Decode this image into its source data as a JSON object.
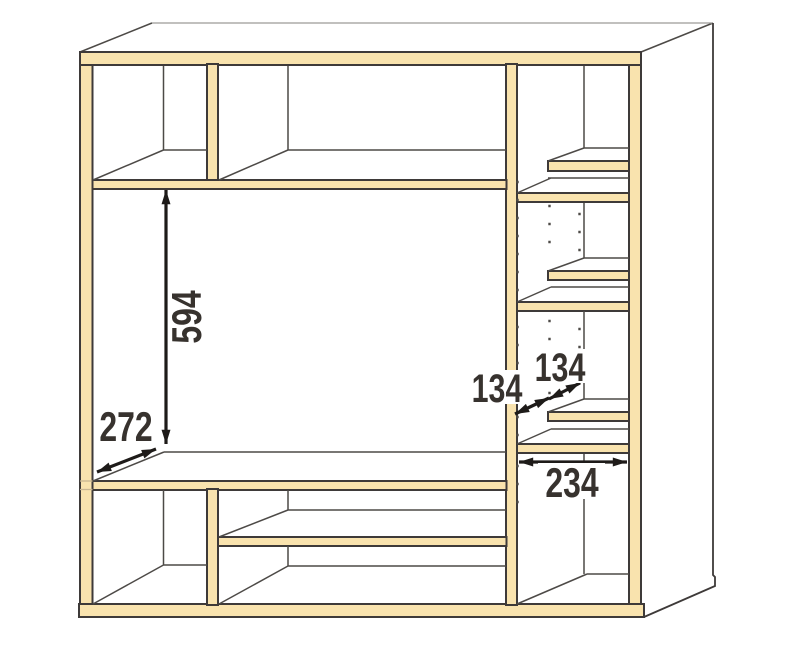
{
  "diagram": {
    "background": "#FFFFFF",
    "colors": {
      "wood": "#F9E3AE",
      "outline": "#3E3A39",
      "interior": "#4D4A47",
      "backline": "#9C9A98",
      "wood_shadow": "#C9B691",
      "dimension": "#1E1B19",
      "label": "#37322E"
    },
    "dimensions": [
      {
        "id": "opening-height",
        "value": "594"
      },
      {
        "id": "main-shelf-depth",
        "value": "272"
      },
      {
        "id": "side-front-shelf-depth",
        "value": "134"
      },
      {
        "id": "side-back-shelf-depth",
        "value": "134"
      },
      {
        "id": "side-column-inner-width",
        "value": "234"
      }
    ]
  }
}
